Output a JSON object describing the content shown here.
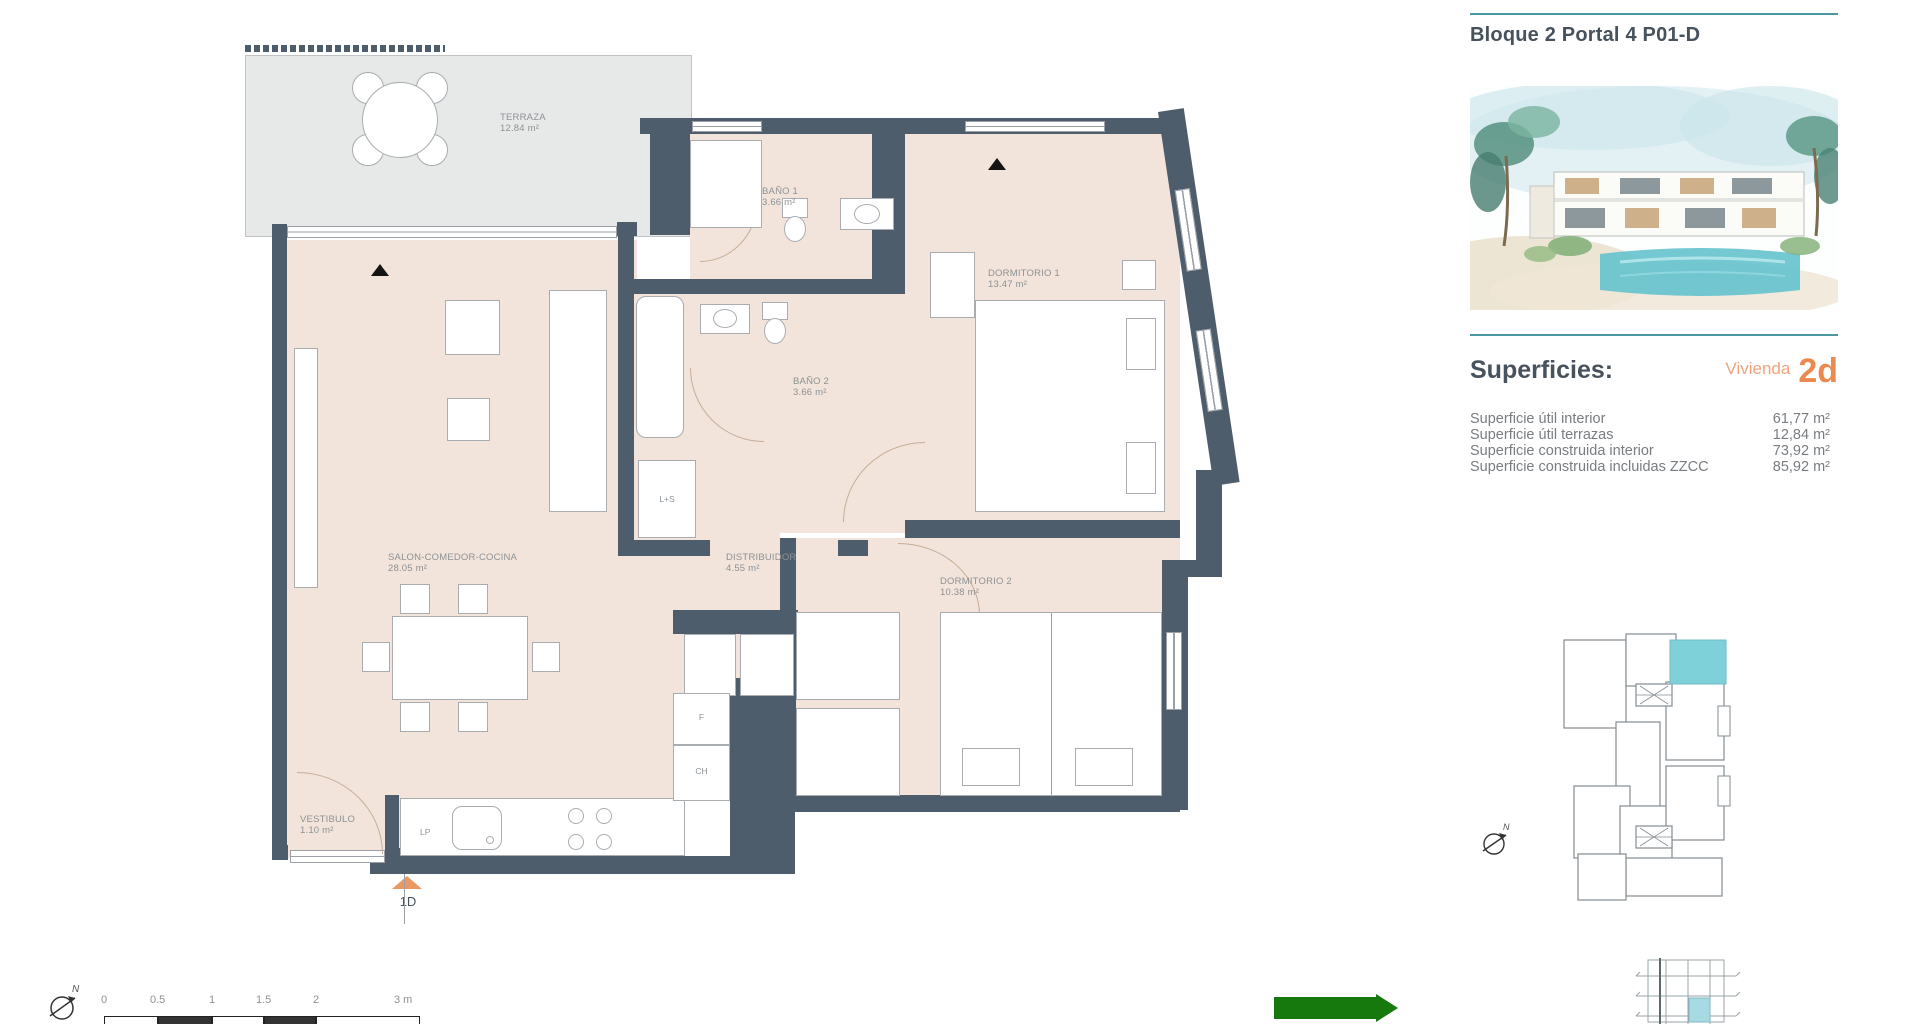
{
  "header": {
    "title": "Bloque 2 Portal 4 P01-D"
  },
  "superficies": {
    "heading": "Superficies:",
    "vivienda_label": "Vivienda",
    "vivienda_code": "2d",
    "rows": [
      {
        "label": "Superficie útil interior",
        "value": "61,77 m²"
      },
      {
        "label": "Superficie útil terrazas",
        "value": "12,84 m²"
      },
      {
        "label": "Superficie construida interior",
        "value": "73,92 m²"
      },
      {
        "label": "Superficie construida incluidas ZZCC",
        "value": "85,92 m²"
      }
    ]
  },
  "plan": {
    "rooms": [
      {
        "name": "TERRAZA",
        "area": "12.84 m²"
      },
      {
        "name": "BAÑO 1",
        "area": "3.66 m²"
      },
      {
        "name": "DORMITORIO 1",
        "area": "13.47 m²"
      },
      {
        "name": "BAÑO 2",
        "area": "3.66 m²"
      },
      {
        "name": "SALON-COMEDOR-COCINA",
        "area": "28.05 m²"
      },
      {
        "name": "DISTRIBUIDOR",
        "area": "4.55 m²"
      },
      {
        "name": "DORMITORIO 2",
        "area": "10.38 m²"
      },
      {
        "name": "VESTIBULO",
        "area": "1.10 m²"
      }
    ],
    "labels": {
      "ls": "L+S",
      "f": "F",
      "ch": "CH",
      "lp": "LP",
      "entrance": "1D"
    }
  },
  "scalebar": {
    "north": "N",
    "ticks": [
      "0",
      "0.5",
      "1",
      "1.5",
      "2",
      "3 m"
    ]
  },
  "colors": {
    "wall": "#4e5d6b",
    "floor": "#f2e4da",
    "terrace": "#e7e8e8",
    "teal_line": "#4b98a2",
    "unit_highlight": "#7ed0d9",
    "orange": "#ea8a51",
    "green_arrow": "#15790d"
  }
}
